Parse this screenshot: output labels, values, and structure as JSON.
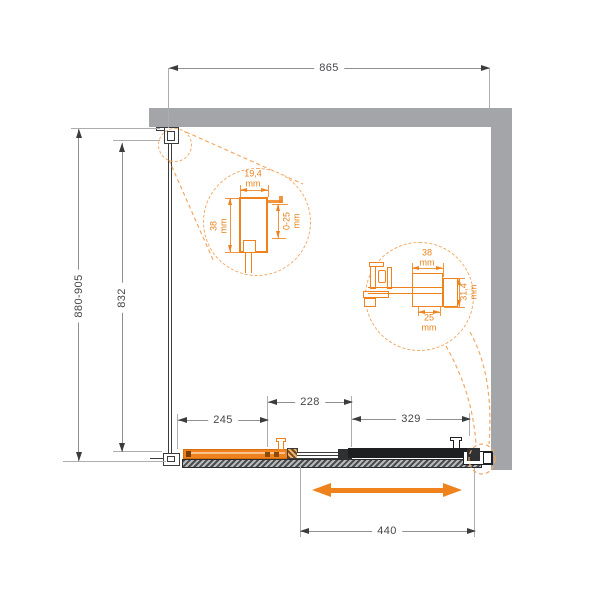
{
  "unit_mm": "mm",
  "dims": {
    "width_top": "865",
    "height_range": "880-905",
    "glass_height": "832",
    "fixed_panel": "245",
    "overlap": "228",
    "door_panel": "329",
    "slide_travel": "440"
  },
  "detail_left": {
    "profile_width": "19,4",
    "profile_height": "38",
    "adjust_range": "0-25"
  },
  "detail_right": {
    "rail_width": "38",
    "rail_height": "31,4",
    "inner_width": "25"
  },
  "colors": {
    "accent": "#F0821E",
    "accent-dark": "#D96D0E",
    "accent-light": "#F2A964",
    "accent-text": "#E8821A",
    "wall": "#A4A5A8",
    "line": "#3B3C3E",
    "black": "#1E1F21",
    "dim-line": "#8E8F92",
    "ext-line": "#ACADAF",
    "text": "#46474B"
  }
}
